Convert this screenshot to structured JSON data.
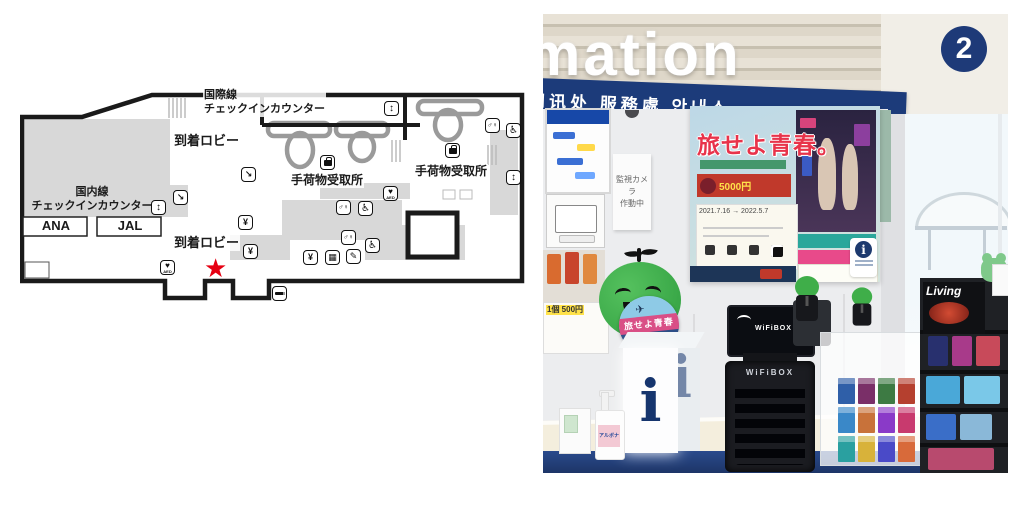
{
  "map": {
    "labels": {
      "intl_checkin": "国際線\nチェックインカウンター",
      "arrival_lobby_upper": "到着ロビー",
      "baggage_claim_left": "手荷物受取所",
      "baggage_claim_right": "手荷物受取所",
      "domestic_checkin": "国内線\nチェックインカウンター",
      "airline_ana": "ANA",
      "airline_jal": "JAL",
      "arrival_lobby_lower": "到着ロビー"
    },
    "icon_glyphs": {
      "escalator": "↘",
      "elevator": "↕",
      "restroom": "♂♀",
      "wheelchair": "♿",
      "aed_heart": "♥",
      "aed_label": "AED",
      "yen": "¥",
      "pen": "✎",
      "lockers": "▦",
      "star": "★"
    },
    "colors": {
      "current_location_star": "#e60012",
      "zone_fill": "#d8d8d8",
      "wall": "#1a1a1a"
    }
  },
  "photo": {
    "header": {
      "sign_word": "mation",
      "counter_number": "2",
      "languages": "问讯处 服務處 안내소",
      "band_color": "#1c3b7a"
    },
    "camera_notice": "監視カメラ\n作動中",
    "poster": {
      "title": "旅せよ青春。",
      "price": "5000円",
      "period": "2021.7.16 → 2022.5.7"
    },
    "badge_title": "旅せよ青春",
    "info_cube_letter": "i",
    "info_card_letter": "i",
    "wifibox_brand": "WiFiBOX",
    "sanitizer_label": "アルボナース",
    "magazine_title": "Living",
    "price_note": "1個 500円",
    "mascot_color": "#3fae49"
  }
}
